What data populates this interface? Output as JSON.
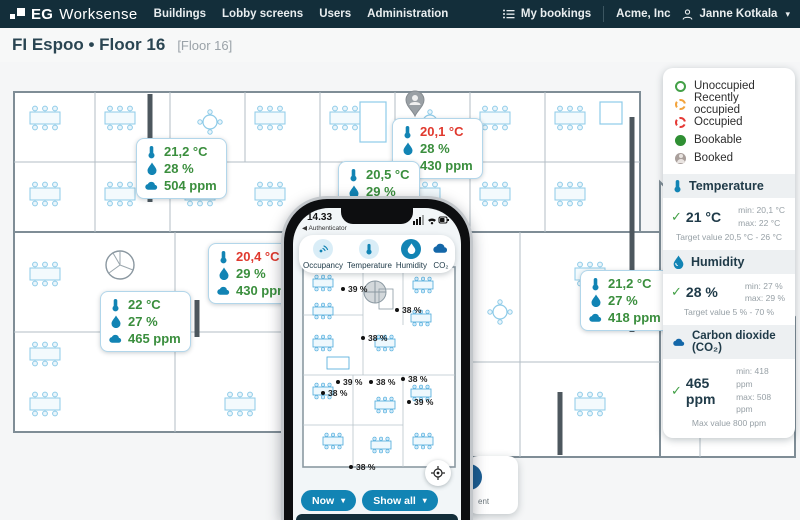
{
  "colors": {
    "navy": "#132e3a",
    "accent": "#1284b4",
    "ok_green": "#3a8e3d",
    "alert_red": "#e0392e"
  },
  "nav": {
    "brand": {
      "eg": "EG",
      "word": "Worksense"
    },
    "items": [
      {
        "label": "Buildings"
      },
      {
        "label": "Lobby screens"
      },
      {
        "label": "Users"
      },
      {
        "label": "Administration"
      }
    ],
    "my_bookings": "My bookings",
    "company": "Acme, Inc",
    "user": "Janne Kotkala"
  },
  "header": {
    "title": "FI Espoo • Floor 16",
    "tag": "[Floor 16]"
  },
  "legend": {
    "items": [
      {
        "label": "Unoccupied"
      },
      {
        "label": "Recently occupied"
      },
      {
        "label": "Occupied"
      },
      {
        "label": "Bookable"
      },
      {
        "label": "Booked"
      }
    ]
  },
  "panel": {
    "temperature": {
      "title": "Temperature",
      "value": "21 °C",
      "min": "min: 20,1 °C",
      "max": "max: 22 °C",
      "target": "Target value 20,5 °C - 26 °C"
    },
    "humidity": {
      "title": "Humidity",
      "value": "28 %",
      "min": "min: 27 %",
      "max": "max: 29 %",
      "target": "Target value 5 % - 70 %"
    },
    "co2": {
      "title": "Carbon dioxide (CO₂)",
      "value": "465 ppm",
      "min": "min: 418 ppm",
      "max": "max: 508 ppm",
      "target": "Max value 800 ppm"
    }
  },
  "badges": [
    {
      "temp": "21,2 °C",
      "humidity": "28 %",
      "co2": "504 ppm"
    },
    {
      "temp": "20,1 °C",
      "humidity": "28 %",
      "co2": "430 ppm"
    },
    {
      "temp": "20,5 °C",
      "humidity": "29 %"
    },
    {
      "temp": "20,4 °C",
      "humidity": "29 %",
      "co2": "430 ppm"
    },
    {
      "temp": "22 °C",
      "humidity": "27 %",
      "co2": "465 ppm"
    },
    {
      "temp": "21,2 °C",
      "humidity": "27 %",
      "co2": "418 ppm"
    }
  ],
  "phone": {
    "time": "14.33",
    "back_app": "◀ Authenticator",
    "tabs": [
      {
        "label": "Occupancy"
      },
      {
        "label": "Temperature"
      },
      {
        "label": "Humidity"
      },
      {
        "label": "CO₂"
      }
    ],
    "readings": [
      {
        "value": "39 %"
      },
      {
        "value": "38 %"
      },
      {
        "value": "38 %"
      },
      {
        "value": "39 %"
      },
      {
        "value": "38 %"
      },
      {
        "value": "38 %"
      },
      {
        "value": "38 %"
      },
      {
        "value": "39 %"
      },
      {
        "value": "38 %"
      }
    ],
    "now_button": "Now",
    "show_all_button": "Show all"
  },
  "fragment_card": {
    "text": "ent"
  }
}
